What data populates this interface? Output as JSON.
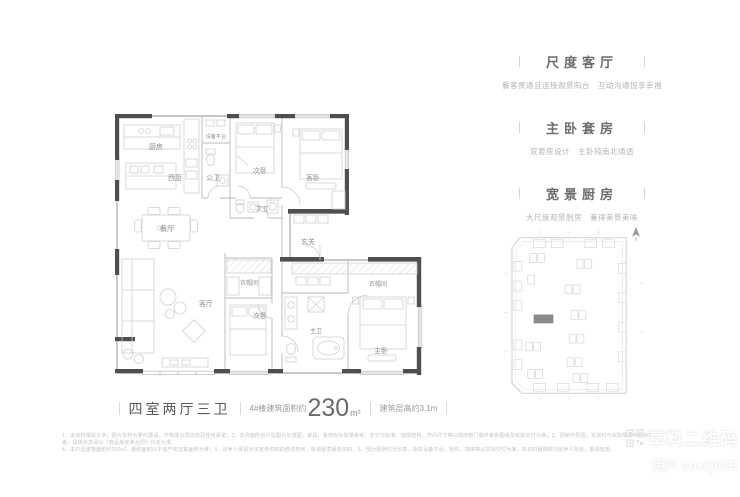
{
  "features": [
    {
      "title": "尺度客厅",
      "desc": "餐客贯通且连接观景阳台　互动沟通悦享幸福"
    },
    {
      "title": "主卧套房",
      "desc": "双套房设计　主卧纯南北通透"
    },
    {
      "title": "宽景厨房",
      "desc": "大尺度观景厨房　兼得美景美味"
    }
  ],
  "floorplan": {
    "rooms": {
      "kitchen": "厨房",
      "equipment_platform": "设备平台",
      "west_kitchen": "西厨",
      "public_bath": "公卫",
      "bedroom2_top": "次卧",
      "guest_bedroom": "客卧",
      "bath2": "次卫",
      "dining": "餐厅",
      "foyer": "玄关",
      "cloakroom_left": "衣帽间",
      "living": "客厅",
      "bedroom3_bottom": "次卧",
      "master_bath": "主卫",
      "cloakroom_right": "衣帽间",
      "master_bedroom": "主卧"
    }
  },
  "caption": {
    "layout_name": "四室两厅三卫",
    "area_prefix": "4#楼建筑面积约",
    "area_value": "230",
    "area_unit": "m²",
    "floor_height": "建筑层高约3.1m"
  },
  "disclaimer": {
    "line1": "1、本资料相关文字、图片仅作为要约邀请，不构成合同内容及任何承诺；2、本页面所示户型图为示意图，家具、装饰仅为效果参考，非交付标准，墙体结构、开间尺寸等以政府部门最终审批图纸及实际交付为准；3、因制作原因，本资料与实际情况可能存在误差，具体信息请以《商品房买卖合同》约定为准；",
    "line2": "4、本户型建筑面积约230㎡，最终面积以不动产权证载面积为准；5、出卖人保留对本宣传资料的修改权利，敬请留意最新资料；6、部分图例仅为示意，相关设备平台、管井、墙体等以实际交付为准，本资料解释权归出卖人所有，敬请知悉。"
  },
  "watermark": {
    "brand": "草料二维码",
    "user": "用户 coxQ04B"
  }
}
